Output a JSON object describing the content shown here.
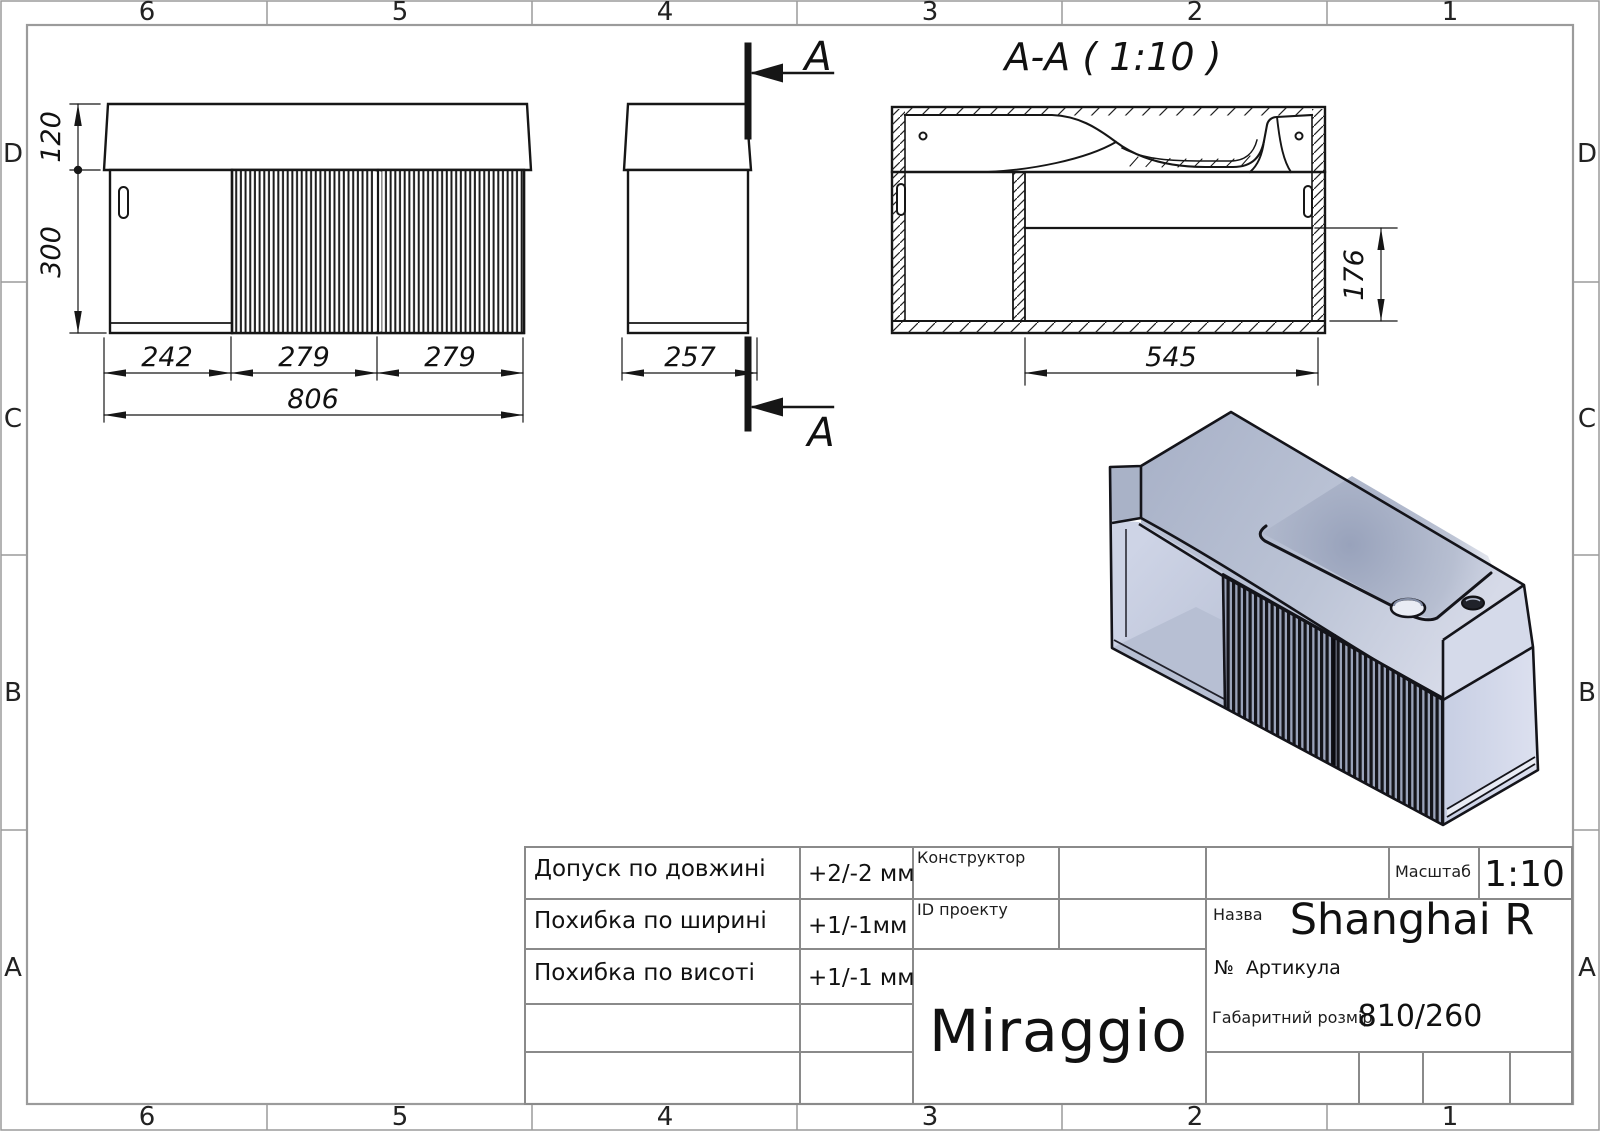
{
  "frame": {
    "columns": [
      "6",
      "5",
      "4",
      "3",
      "2",
      "1"
    ],
    "rows": [
      "D",
      "C",
      "B",
      "A"
    ]
  },
  "drawing": {
    "section_title": "A-A ( 1:10 )",
    "cut_label": "A",
    "dims": {
      "d120": "120",
      "d300": "300",
      "d242": "242",
      "d279a": "279",
      "d279b": "279",
      "d806": "806",
      "d257": "257",
      "d545": "545",
      "d176": "176"
    }
  },
  "title_block": {
    "tolerances": [
      {
        "label": "Допуск по довжині",
        "value": "+2/-2 мм"
      },
      {
        "label": "Похибка по ширині",
        "value": "+1/-1мм"
      },
      {
        "label": "Похибка по висоті",
        "value": "+1/-1 мм"
      }
    ],
    "constructor_label": "Конструктор",
    "project_id_label": "ID проекту",
    "scale_label": "Масштаб",
    "scale_value": "1:10",
    "name_label": "Назва",
    "name_value": "Shanghai R",
    "article_label": "№  Артикула",
    "size_label": "Габаритний розмір",
    "size_value": "810/260",
    "logo": "Miraggio"
  },
  "colors": {
    "line": "#161616",
    "frame_line": "#9b9b9b",
    "titleblock_line": "#8a8a8a",
    "iso_top_light": "#d6dae8",
    "iso_top_dark": "#aab3c9",
    "iso_front_band": "#b9c1d4",
    "iso_right_face": "#ced4e8",
    "iso_rib_dark": "#15151b",
    "iso_rib_light": "#9aa3ba",
    "iso_niche_back": "#c8cfe2",
    "iso_niche_floor": "#b7bfd3"
  }
}
